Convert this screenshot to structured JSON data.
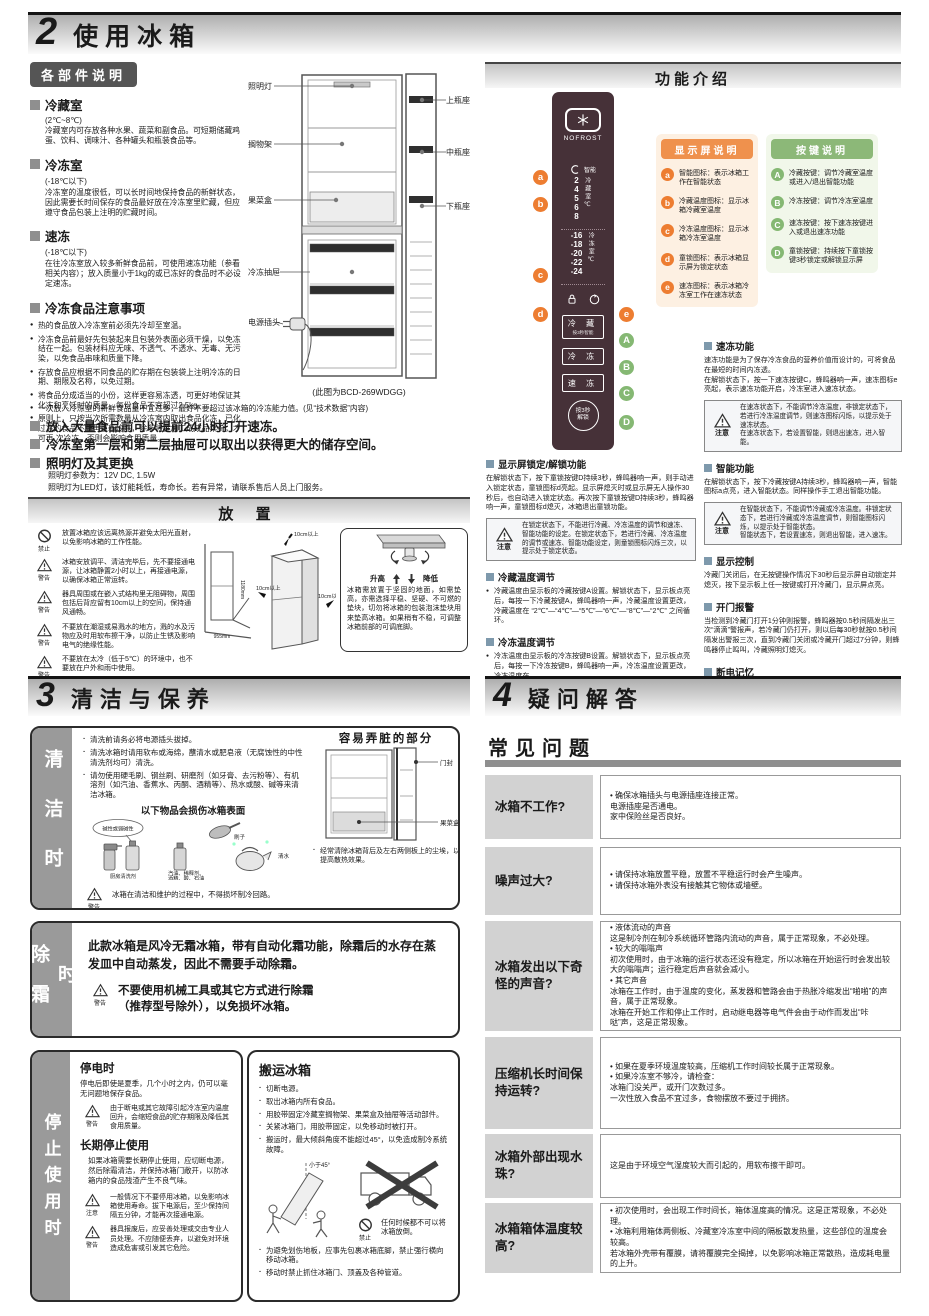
{
  "section2": {
    "number": "2",
    "title": "使用冰箱",
    "parts": {
      "header": "各部件说明",
      "items": [
        {
          "title": "冷藏室",
          "sub": "(2℃~8℃)",
          "text": "冷藏室内可存放各种水果、蔬菜和副食品。可短期储藏鸡蛋、饮料、调味汁、各种罐头和瓶装食品等。"
        },
        {
          "title": "冷冻室",
          "sub": "(-18℃以下)",
          "text": "冷冻室的温度很低，可以长时间地保持食品的新鲜状态，因此需要长时间保存的食品最好放在冷冻室里贮藏，但应遵守食品包装上注明的贮藏时间。"
        },
        {
          "title": "速冻",
          "sub": "(-18℃以下)",
          "text": "在往冷冻室放入较多新鲜食品前，可使用速冻功能（参看相关内容）；放入质量小于1kg的或已冻好的食品时不必设定速冻。"
        }
      ],
      "notes_title": "冷冻食品注意事项",
      "notes": [
        "热的食品放入冷冻室前必须先冷却至室温。",
        "冷冻食品前最好先包装起来且包装外表面必须干燥，以免冻结在一起。包装材料应无味、不透气、不透水、无毒、无污染，以免食品串味和质量下降。",
        "存放食品应根据不同食品的贮存期在包装袋上注明冷冻的日期、期限及名称，以免过期。",
        "将食品分成适当的小份，这样更容易冻透，可更好地保证其化冻和烹饪时的质量，每份食品不宜超过2.5kg。",
        "原则上，只按当次所需数量从冷冻室内取出食品化冻，已化过冻的食品不能再重新冷冻，除非将其加工成成品菜肴，才可再 次冷冻，否则会影响食用质量。"
      ],
      "note_wide": "一次放入冷冻室的新鲜食品量不宜过多，最好不要超过该冰箱的冷冻能力值。(见“技术数据”内容)",
      "extra": [
        "放入大量食品前可以提前24小时打开速冻。",
        "冷冻室第一层和第二层抽屉可以取出以获得更大的储存空间。"
      ],
      "lamp_title": "照明灯及其更换",
      "lamp_text1": "照明灯参数为：12V DC, 1.5W",
      "lamp_text2": "照明灯为LED灯，该灯能耗低，寿命长。若有异常，请联系售后人员上门服务。",
      "diagram": {
        "light": "照明灯",
        "top_rack": "上瓶座",
        "shelf": "搁物架",
        "mid_rack": "中瓶座",
        "veg_box": "果菜盒",
        "bottom_rack": "下瓶座",
        "freezer_drawer": "冷冻抽屉",
        "plug": "电源插头",
        "caption": "(此图为BCD-269WDGG)"
      }
    },
    "placement": {
      "header": "放 置",
      "warnings": [
        {
          "label": "禁止",
          "text": "放置冰箱应该远离热源并避免太阳光直射，以免影响冰箱的工作性能。"
        },
        {
          "label": "警告",
          "text": "冰箱安放调平、清洁完毕后，先不要接通电源，让冰箱静置2小时以上，再接通电源，以确保冰箱正常运转。"
        },
        {
          "label": "警告",
          "text": "器具周围或在嵌入式结构里无阻碍物，周围包括后背应留有10cm以上的空间，保持通风通畅。"
        },
        {
          "label": "警告",
          "text": "不要放在潮湿或易溅水的地方，溅的水及污物应及时用软布擦干净，以防止生锈及影响电气的绝缘性能。"
        },
        {
          "label": "警告",
          "text": "不要放在太冷（低于5℃）的环境中，也不要放在户外和雨中使用。"
        }
      ],
      "dims": {
        "corner_h": "1180mm",
        "corner_w": "955mm",
        "top": "10cm以上",
        "right": "10cm以上",
        "left": "10cm以上"
      },
      "adjust": {
        "raise": "升高",
        "lower": "降低",
        "text": "冰箱需放置于坚固的地面，如需垫高，亦需选择平稳、坚硬、不可燃的垫块，切勿将冰箱的包装泡沫垫块用来垫高冰箱。如果稍有不稳，可调整冰箱前部的可调底脚。"
      }
    },
    "functions": {
      "header": "功能介绍",
      "panel": {
        "brand": "NOFROST",
        "smart_label": "智能",
        "fridge_temps": [
          "2",
          "4",
          "5",
          "6",
          "8"
        ],
        "fridge_unit": "冷藏室℃",
        "freezer_temps": [
          "-16",
          "-18",
          "-20",
          "-22",
          "-24"
        ],
        "freezer_unit": "冷冻室℃",
        "buttons": [
          {
            "label": "冷 藏",
            "sub": "按3秒智能"
          },
          {
            "label": "冷 冻",
            "sub": ""
          },
          {
            "label": "速 冻",
            "sub": ""
          }
        ],
        "round_button": "按3秒\n解锁"
      },
      "display_legend": {
        "header": "显示屏说明",
        "items": [
          {
            "key": "a",
            "text": "智能图标：表示冰箱工作在智能状态"
          },
          {
            "key": "b",
            "text": "冷藏温度图标：显示冰箱冷藏室温度"
          },
          {
            "key": "c",
            "text": "冷冻温度图标：显示冰箱冷冻室温度"
          },
          {
            "key": "d",
            "text": "童锁图标：表示冰箱显示屏为锁定状态"
          },
          {
            "key": "e",
            "text": "速冻图标：表示冰箱冷冻室工作在速冻状态"
          }
        ]
      },
      "key_legend": {
        "header": "按键说明",
        "items": [
          {
            "key": "A",
            "text": "冷藏按键：调节冷藏室温度或进入/退出智能功能"
          },
          {
            "key": "B",
            "text": "冷冻按键：调节冷冻室温度"
          },
          {
            "key": "C",
            "text": "速冻按键：按下速冻按键进入或退出速冻功能"
          },
          {
            "key": "D",
            "text": "童锁按键：持续按下童锁按键3秒锁定或解锁显示屏"
          }
        ]
      },
      "note_label": "注意",
      "sections_right": [
        {
          "title": "速冻功能",
          "text": "速冻功能是为了保存冷冻食品的营养价值而设计的，可将食品在最短的时间内冻透。\n在解锁状态下，按一下速冻按键C，蜂鸣器响一声，速冻图标e亮起，表示速冻功能开启，冷冻室进入速冻状态。",
          "note": "在速冻状态下，不能调节冷冻温度，非锁定状态下，若进行冷冻温度调节，则速冻图标闪烁，以提示处于速冻状态。\n在速冻状态下，若设置智能，则退出速冻，进入智能。"
        },
        {
          "title": "智能功能",
          "text": "在解锁状态下，按下冷藏按键A持续3秒，蜂鸣器响一声，智能图标a点亮，进入智能状态。同样操作手工退出智能功能。",
          "note": "在智能状态下，不能调节冷藏或冷冻温度。非锁定状态下，若进行冷藏或冷冻温度调节，则智能图标闪烁，以提示处于智能状态。\n智能状态下，若设置速冻，则退出智能，进入速冻。"
        },
        {
          "title": "显示控制",
          "text": "冷藏门关闭后，在无按键操作情况下30秒后显示屏自动锁定并熄灭，按下显示板上任一按键或打开冷藏门，显示屏点亮。"
        },
        {
          "title": "开门报警",
          "text": "当检测到冷藏门打开1分钟则报警，蜂鸣器按0.5秒间隔发出三次“滴滴”警报声，若冷藏门仍打开，则以后每30秒就按0.5秒间隔发出警报三次，直到冷藏门关闭或冷藏开门超过7分钟，则蜂鸣器停止鸣叫，冷藏照明灯熄灭。"
        },
        {
          "title": "断电记忆",
          "text": "本产品有断电记忆功能，断电时的临时设定状态会被记忆，来电后仍按断电前的设定状态工作。"
        }
      ],
      "sections_left": [
        {
          "title": "显示屏锁定/解锁功能",
          "text": "在解锁状态下，按下童锁按键D持续3秒，蜂鸣器响一声，则手动进入锁定状态，童锁图标d亮起。显示屏熄灭时或显示屏无人操作30秒后，也自动进入锁定状态。再次按下童锁按键D持续3秒，蜂鸣器响一声，童锁图标d熄灭，冰箱退出童锁功能。",
          "note": "在锁定状态下，不能进行冷藏、冷冻温度的调节和速冻、智能功能的设定。在锁定状态下，若进行冷藏、冷冻温度的调节或速冻、智能功能设定，则童锁图标闪烁三次，以提示处于锁定状态。"
        },
        {
          "title": "冷藏温度调节",
          "text": "冷藏温度由显示板的冷藏按键A设置。解锁状态下，显示板点亮后，每按一下冷藏按键A，蜂鸣器响一声，冷藏温度设置更改，冷藏温度在 “2℃”—“4℃”—“5℃”—“6℃”—“8℃”—“2℃” 之间循环。"
        },
        {
          "title": "冷冻温度调节",
          "text": "冷冻温度由显示板的冷冻按键B设置。解锁状态下，显示板点亮后，每按一下冷冻按键B，蜂鸣器响一声，冷冻温度设置更改，冷冻温度在 “-16℃”—“-18℃”—“-20℃”—“-22℃”—“-24℃”—“-16℃” 之间循环。"
        }
      ]
    }
  },
  "section3": {
    "number": "3",
    "title": "清洁与保养",
    "cleaning": {
      "side_label": "清洁时",
      "bullets": [
        "清洗前请务必将电源插头拔掉。",
        "清洗冰箱时请用软布或海绵，蘸清水或肥皂液（无腐蚀性的中性清洗剂均可）清洗。",
        "请勿使用硬毛刷、钢丝刷、研磨剂（如牙膏、去污粉等）、有机溶剂（如汽油、香蕉水、丙酮、酒精等）、热水或酸、碱等来清洁冰箱。"
      ],
      "damage_title": "以下物品会损伤冰箱表面",
      "damage_labels": {
        "bubble": "碱性或弱碱性",
        "brush": "刷子",
        "kitchen": "厨房清洗剂",
        "solvent1": "汽油、稀释剂、",
        "solvent2": "酒精、酸、石油",
        "water": "清水"
      },
      "dirty_title": "容易弄脏的部分",
      "dirty_labels": {
        "door": "门封",
        "box": "果菜盒"
      },
      "dirty_note": "经常清除冰箱背后及左右两侧板上的尘埃，以提高散热效果。",
      "warn": {
        "label": "警告",
        "text": "冰箱在清洁和维护的过程中，不得损坏制冷回路。"
      },
      "note": {
        "label": "注意",
        "text": "清洁时不要用水喷淋冲洗，以免影响电气绝缘性能。清洁温控旋钮和照明灯等电气件的时候，请使用干抹布。"
      }
    },
    "defrost": {
      "side_label": "除霜时",
      "text": "此款冰箱是风冷无霜冰箱，带有自动化霜功能，除霜后的水存在蒸发皿中自动蒸发，因此不需要手动除霜。",
      "warn": {
        "label": "警告",
        "text": "不要使用机械工具或其它方式进行除霜\n（推荐型号除外），以免损坏冰箱。"
      }
    },
    "stop": {
      "side_label": "停止使用时",
      "power_off_title": "停电时",
      "power_off_text": "停电后即使是夏季，几个小时之内，仍可以毫无问题地保存食品。",
      "power_off_warn": {
        "label": "警告",
        "text": "由于断电或其它故障引起冷冻室内温度回升，会缩短食品的贮存期限及降低其食用质量。"
      },
      "longterm_title": "长期停止使用",
      "longterm_text": "如果冰箱需要长期停止使用，应切断电源，然后除霜清洁，并保持冰箱门敞开，以防冰箱内的食品残渣产生不良气味。",
      "longterm_note": {
        "label": "注意",
        "text": "一般情况下不要停用冰箱，以免影响冰箱使用寿命。拔下电源后，至少保持间隔五分钟，才能再次接通电源。"
      },
      "longterm_warn": {
        "label": "警告",
        "text": "器具报废后，应妥善处理或交由专业人员处理。不应随便丢弃，以避免对环境造成危害或引发其它危险。"
      }
    },
    "move": {
      "title": "搬运冰箱",
      "bullets": [
        "切断电源。",
        "取出冰箱内所有食品。",
        "用胶带固定冷藏室搁物架、果菜盒及抽屉等活动部件。",
        "关紧冰箱门，用胶带固定，以免移动时被打开。",
        "搬运时，最大倾斜角度不能超过45°，以免造成制冷系统故障。"
      ],
      "angle": "小于45°",
      "prohibit_label": "禁止",
      "prohibit_text": "任何时候都不可以将冰箱放倒。",
      "bullets2": [
        "为避免划伤地板，应事先包裹冰箱底脚，禁止强行横向移动冰箱。",
        "移动时禁止抓住冰箱门、顶盖及各种管道。"
      ]
    }
  },
  "section4": {
    "number": "4",
    "title": "疑问解答",
    "faq_title": "常见问题",
    "rows": [
      {
        "q": "冰箱不工作?",
        "a": "• 确保冰箱插头与电源插座连接正常。\n  电源插座是否通电。\n  家中保险丝是否良好。"
      },
      {
        "q": "噪声过大?",
        "a": "• 请保持冰箱放置平稳，放置不平稳运行时会产生噪声。\n• 请保持冰箱外表没有接触其它物体或墙壁。"
      },
      {
        "q": "冰箱发出以下奇怪的声音?",
        "a": "• 液体流动的声音\n  这是制冷剂在制冷系统循环管路内流动的声音，属于正常现象，不必处理。\n• 较大的嗡嗡声\n  初次使用时，由于冰箱的运行状态还没有稳定，所以冰箱在开始运行时会发出较大的嗡嗡声；运行稳定后声音就会减小。\n• 其它声音\n  冰箱在工作时，由于温度的变化，蒸发器和管路会由于热胀冷缩发出“啪啪”的声音，属于正常现象。\n  冰箱在开始工作和停止工作时，启动继电器等电气件会由于动作而发出“咔哒”声，这是正常现象。"
      },
      {
        "q": "压缩机长时间保持运转?",
        "a": "• 如果在夏季环境温度较高，压缩机工作时间较长属于正常现象。\n• 如果冷冻室不够冷，请检查：\n  冰箱门没关严，或开门次数过多。\n  一次性放入食品不宜过多，食物摆放不要过于拥挤。"
      },
      {
        "q": "冰箱外部出现水珠?",
        "a": "这是由于环境空气湿度较大而引起的，用软布擦干即可。"
      },
      {
        "q": "冰箱箱体温度较高?",
        "a": "• 初次使用时，会出现工作时间长，箱体温度高的情况。这是正常现象，不必处理。\n• 冰箱利用箱体两侧板、冷藏室冷冻室中间的隔板散发热量，这些部位的温度会较高。\n  若冰箱外壳带有覆膜，请将覆膜完全揭掉，以免影响冰箱正常散热，造成耗电量的上升。"
      }
    ]
  }
}
